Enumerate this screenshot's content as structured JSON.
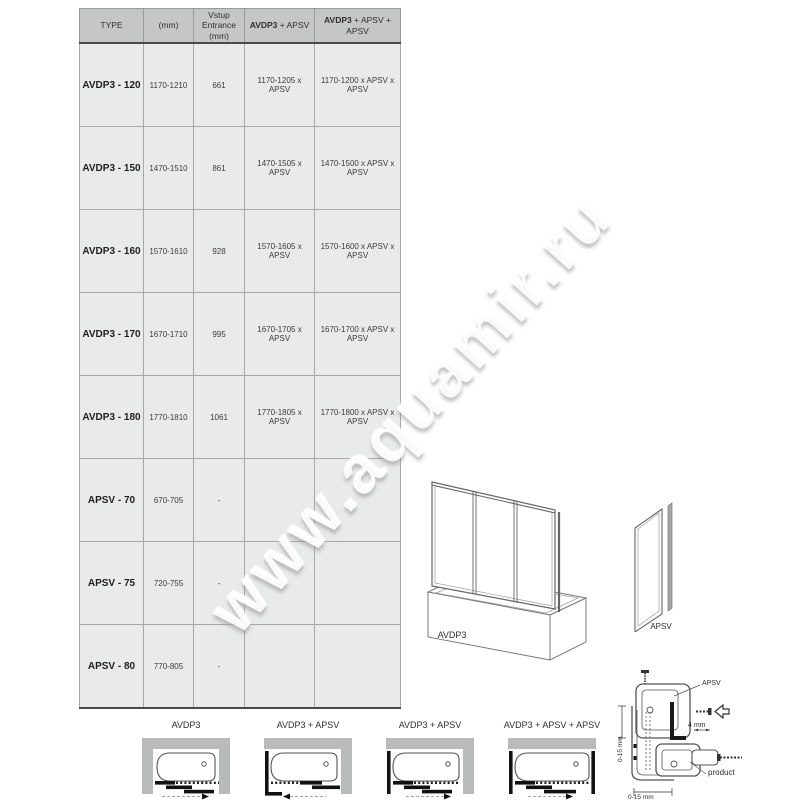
{
  "watermark": {
    "text": "www.aquamir.ru"
  },
  "table": {
    "headers": {
      "type": "TYPE",
      "mm": "(mm)",
      "entrance": "Vstup Entrance (mm)",
      "combo1_bold": "AVDP3",
      "combo1_rest": " + APSV",
      "combo2_bold": "AVDP3",
      "combo2_rest": " + APSV + APSV"
    },
    "rows": [
      {
        "type": "AVDP3 - 120",
        "mm": "1170-1210",
        "entrance": "661",
        "combo1": "1170-1205 x APSV",
        "combo2": "1170-1200 x APSV x APSV"
      },
      {
        "type": "AVDP3 - 150",
        "mm": "1470-1510",
        "entrance": "861",
        "combo1": "1470-1505 x APSV",
        "combo2": "1470-1500 x APSV x APSV"
      },
      {
        "type": "AVDP3 - 160",
        "mm": "1570-1610",
        "entrance": "928",
        "combo1": "1570-1605 x APSV",
        "combo2": "1570-1600 x APSV x APSV"
      },
      {
        "type": "AVDP3 - 170",
        "mm": "1670-1710",
        "entrance": "995",
        "combo1": "1670-1705 x APSV",
        "combo2": "1670-1700 x APSV x APSV"
      },
      {
        "type": "AVDP3 - 180",
        "mm": "1770-1810",
        "entrance": "1061",
        "combo1": "1770-1805 x APSV",
        "combo2": "1770-1800 x APSV x APSV"
      },
      {
        "type": "APSV - 70",
        "mm": "670-705",
        "entrance": "-",
        "combo1": "",
        "combo2": ""
      },
      {
        "type": "APSV - 75",
        "mm": "720-755",
        "entrance": "-",
        "combo1": "",
        "combo2": ""
      },
      {
        "type": "APSV - 80",
        "mm": "770-805",
        "entrance": "-",
        "combo1": "",
        "combo2": ""
      }
    ]
  },
  "product_drawings": {
    "avdp3_label": "AVDP3",
    "apsv_label": "APSV"
  },
  "layout_diagrams": [
    {
      "label": "AVDP3"
    },
    {
      "label": "AVDP3 + APSV"
    },
    {
      "label": "AVDP3 + APSV"
    },
    {
      "label": "AVDP3 + APSV + APSV"
    }
  ],
  "installation_detail": {
    "apsv_label": "APSV",
    "gap_4mm": "4 mm",
    "side_gap": "0-15 mm",
    "bottom_gap": "0-15 mm",
    "product_label": "product"
  },
  "colors": {
    "header_bg": "#c5c7c7",
    "row_bg": "#e9eaea",
    "wall_gray": "#b9bbbb",
    "line_gray": "#666666",
    "black": "#141414"
  }
}
